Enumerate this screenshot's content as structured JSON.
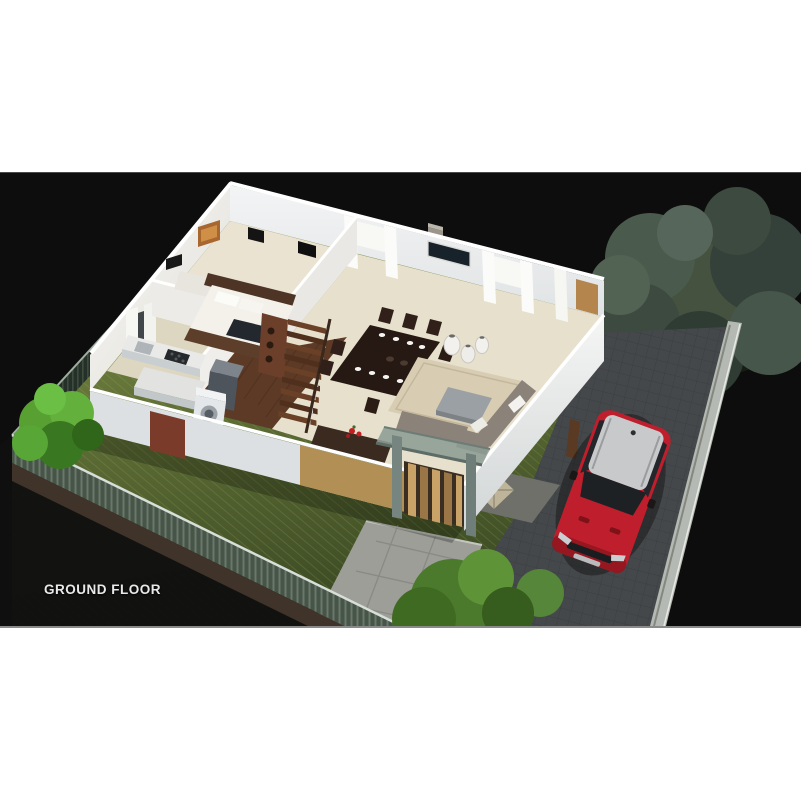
{
  "caption": {
    "label": "GROUND FLOOR",
    "color": "#e9e9e9"
  },
  "panel": {
    "background": "#0d0d0d",
    "page_background": "#ffffff"
  },
  "colors": {
    "lawn": "#66763a",
    "lawn_shaded": "#3c4a24",
    "fence_green": "#243028",
    "fence_rail": "#a8b5a8",
    "boundary_wall": "#b5b9b3",
    "house_wall": "#f1f0ec",
    "wall_accent_tan": "#b29055",
    "floor_cream": "#e7e0cc",
    "wood_floor": "#5d3a26",
    "stair_wood": "#6a4026",
    "dining_table": "#261812",
    "sofa": "#8b8279",
    "rug": "#d8cdb2",
    "driveway": "#46494c",
    "patio": "#6e7069",
    "porch_frame": "#7f8f88",
    "car_body": "#bf1f2c",
    "car_roof": "#c7c9cb",
    "tree_dark": "#44523f",
    "shrub_bright": "#58a032"
  },
  "scene": {
    "objects": [
      "perimeter-fence",
      "lawn",
      "large-tree",
      "left-shrub",
      "cutaway-house",
      "bedroom",
      "kitchen",
      "staircase",
      "dining-set",
      "living-room",
      "porch-canopy",
      "patio-compass-inlay",
      "stone-path",
      "paved-driveway",
      "red-suv",
      "bottom-trees",
      "ground-floor-caption"
    ]
  }
}
